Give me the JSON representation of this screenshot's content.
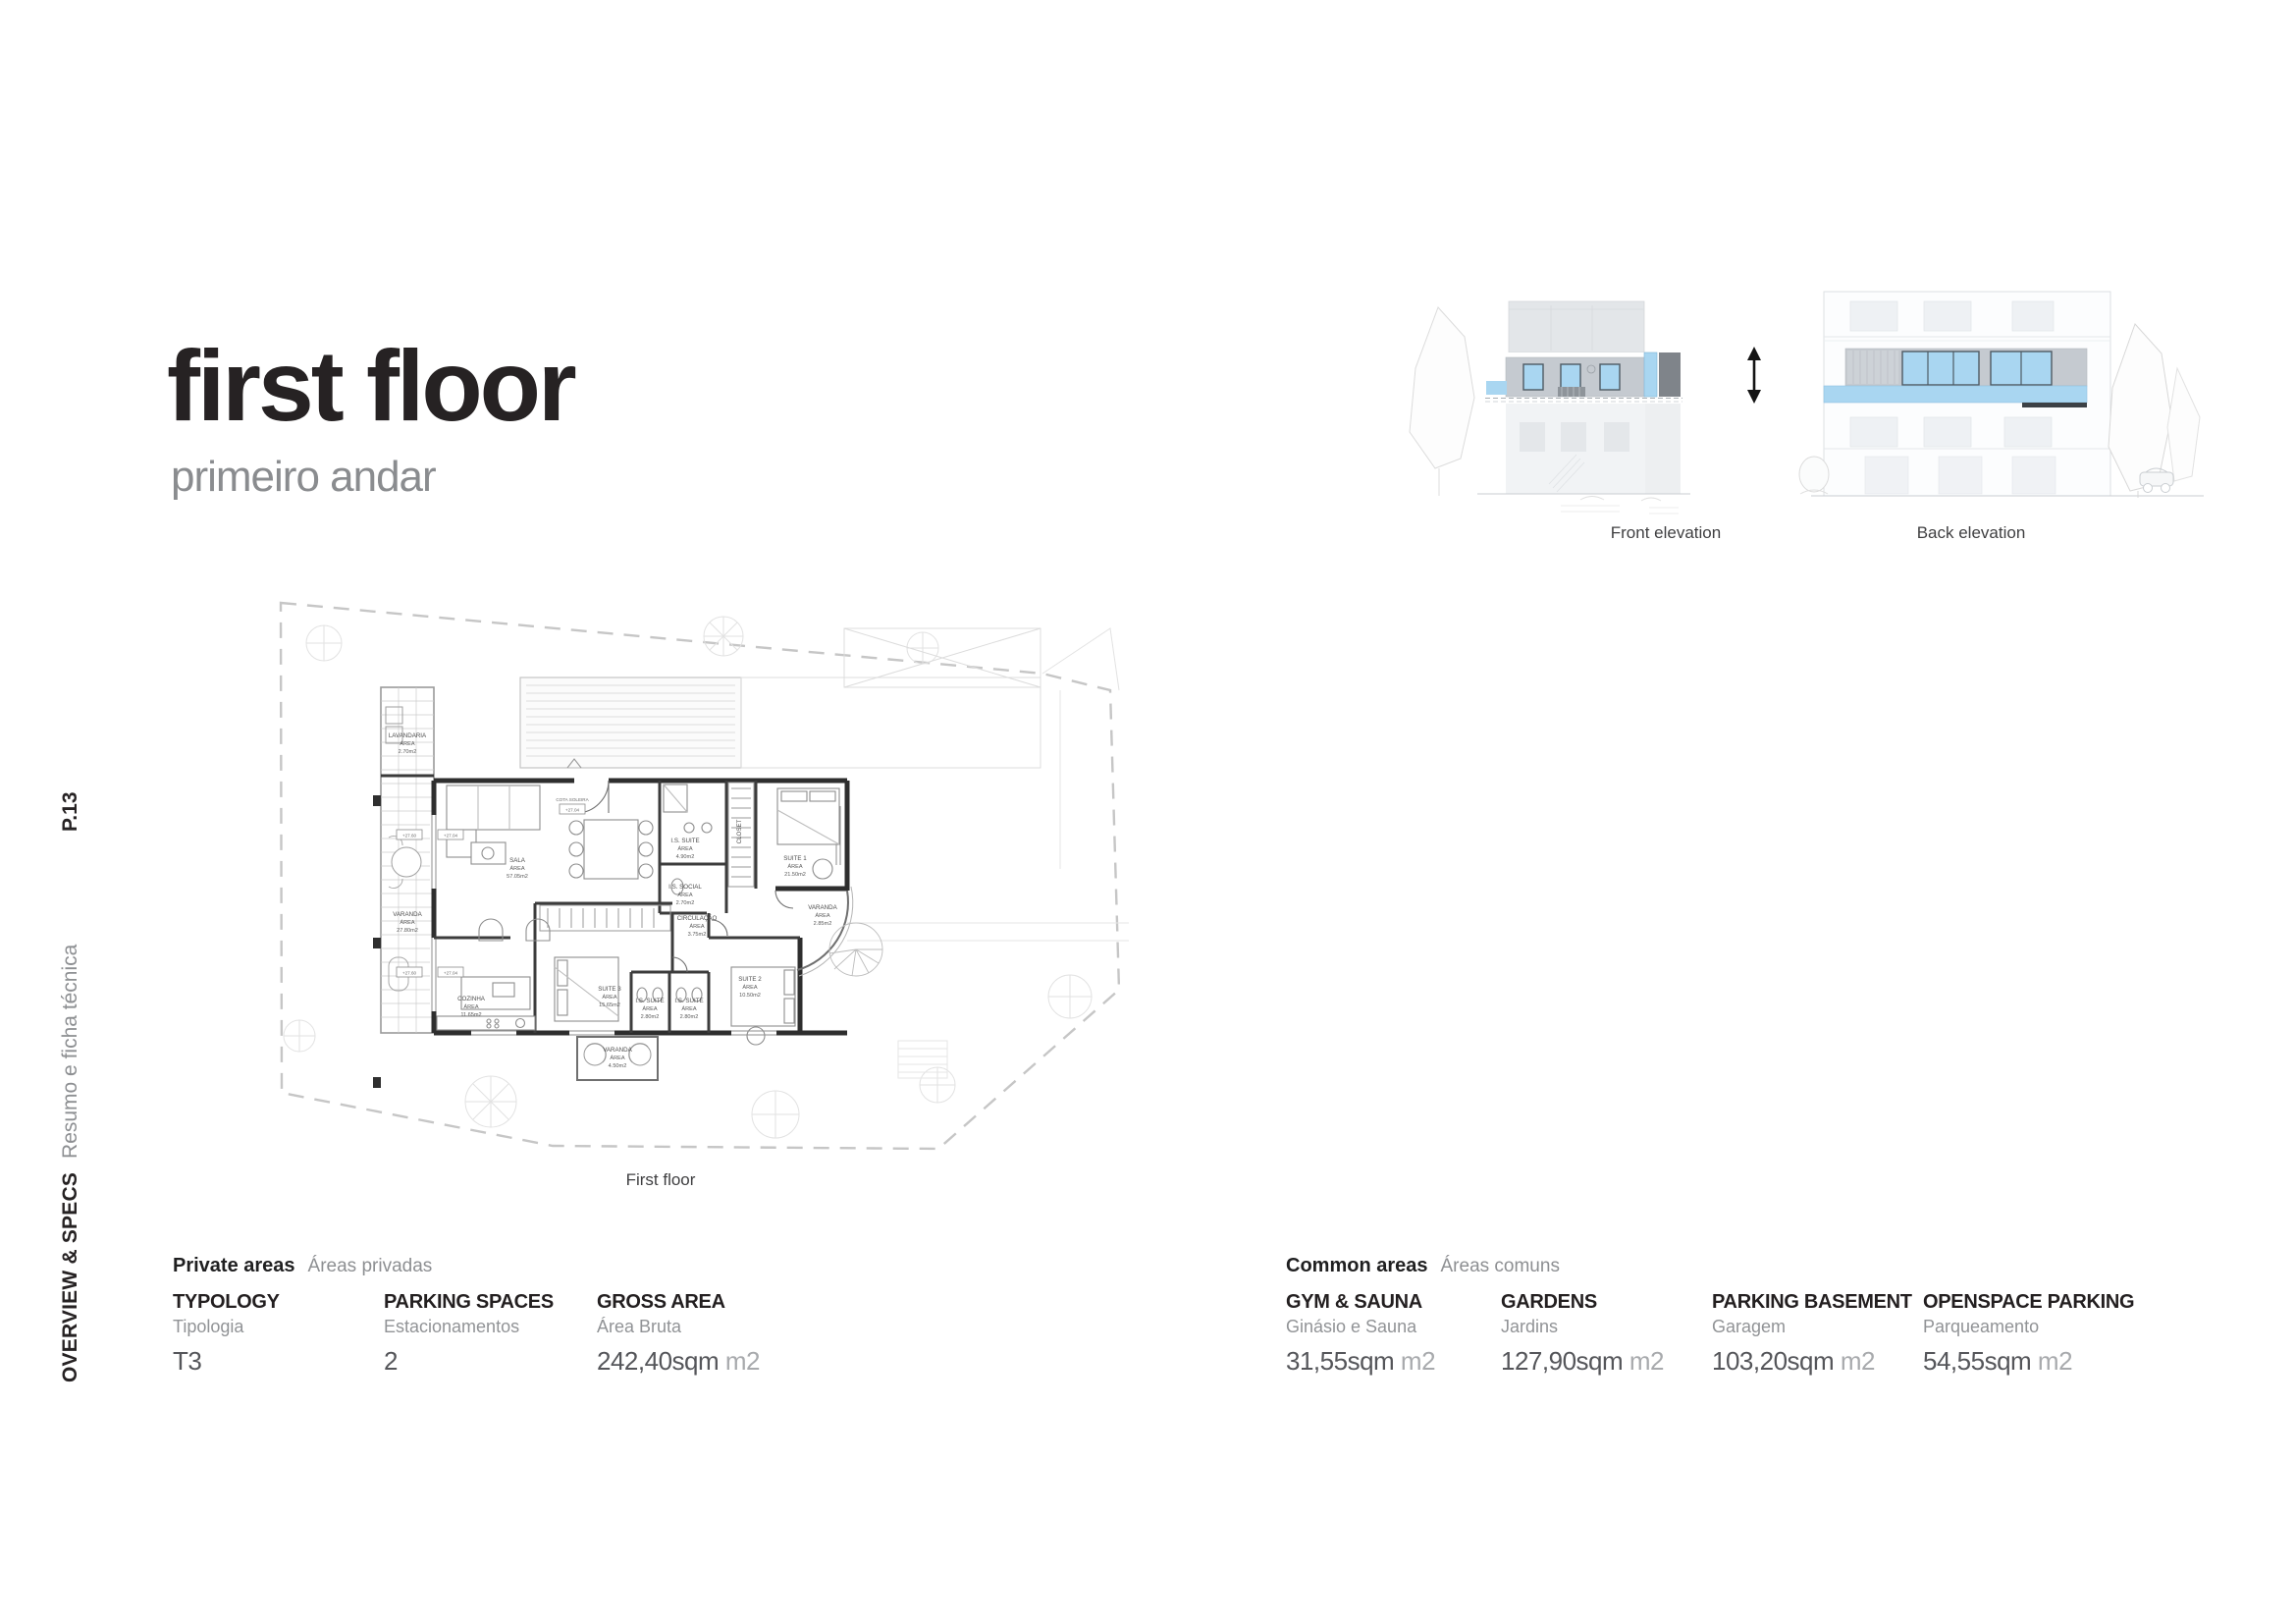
{
  "header": {
    "title": "first floor",
    "subtitle": "primeiro andar"
  },
  "sidebar": {
    "page_number": "P.13",
    "section_en": "OVERVIEW & SPECS",
    "section_pt": "Resumo e ficha técnica"
  },
  "elevations": {
    "front_caption": "Front elevation",
    "back_caption": "Back elevation"
  },
  "floor_plan": {
    "caption": "First floor",
    "area_word": "ÁREA",
    "threshold": {
      "label": "COTA SOLEIRA",
      "value": "+27.04"
    },
    "level_markers": [
      "+27.60",
      "+27.04"
    ],
    "rooms": [
      {
        "name": "LAVANDARIA",
        "area": "2.70m2"
      },
      {
        "name": "VARANDA",
        "area": "27.80m2"
      },
      {
        "name": "SALA",
        "area": "57.05m2"
      },
      {
        "name": "I.S. SUITE",
        "area": "4.90m2"
      },
      {
        "name": "CLOSET",
        "area": ""
      },
      {
        "name": "SUITE 1",
        "area": "21.50m2"
      },
      {
        "name": "I.S. SOCIAL",
        "area": "2.70m2"
      },
      {
        "name": "CIRCULAÇÃO",
        "area": "3.75m2"
      },
      {
        "name": "VARANDA",
        "area": "2.85m2"
      },
      {
        "name": "COZINHA",
        "area": "11.65m2"
      },
      {
        "name": "SUITE 3",
        "area": "15.65m2"
      },
      {
        "name": "I.S. SUITE",
        "area": "2.80m2"
      },
      {
        "name": "I.S. SUITE",
        "area": "2.80m2"
      },
      {
        "name": "SUITE 2",
        "area": "10.50m2"
      },
      {
        "name": "VARANDA",
        "area": "4.50m2"
      }
    ]
  },
  "private_areas": {
    "title_en": "Private areas",
    "title_pt": "Áreas privadas",
    "columns": [
      {
        "label_en": "TYPOLOGY",
        "label_pt": "Tipologia",
        "value": "T3",
        "unit": ""
      },
      {
        "label_en": "PARKING SPACES",
        "label_pt": "Estacionamentos",
        "value": "2",
        "unit": ""
      },
      {
        "label_en": "GROSS AREA",
        "label_pt": "Área Bruta",
        "value": "242,40sqm",
        "unit": "m2"
      }
    ]
  },
  "common_areas": {
    "title_en": "Common areas",
    "title_pt": "Áreas comuns",
    "columns": [
      {
        "label_en": "GYM & SAUNA",
        "label_pt": "Ginásio e Sauna",
        "value": "31,55sqm",
        "unit": "m2"
      },
      {
        "label_en": "GARDENS",
        "label_pt": "Jardins",
        "value": "127,90sqm",
        "unit": "m2"
      },
      {
        "label_en": "PARKING BASEMENT",
        "label_pt": "Garagem",
        "value": "103,20sqm",
        "unit": "m2"
      },
      {
        "label_en": "OPENSPACE PARKING",
        "label_pt": "Parqueamento",
        "value": "54,55sqm",
        "unit": "m2"
      }
    ]
  },
  "colors": {
    "accent_blue": "#a9d6f1",
    "elevation_wall_gray": "#c5cad0",
    "elevation_dark_gray": "#7f848a",
    "text_dark": "#262223",
    "text_gray": "#8d8f92",
    "value_gray": "#55565a",
    "unit_gray": "#a8aaad"
  }
}
